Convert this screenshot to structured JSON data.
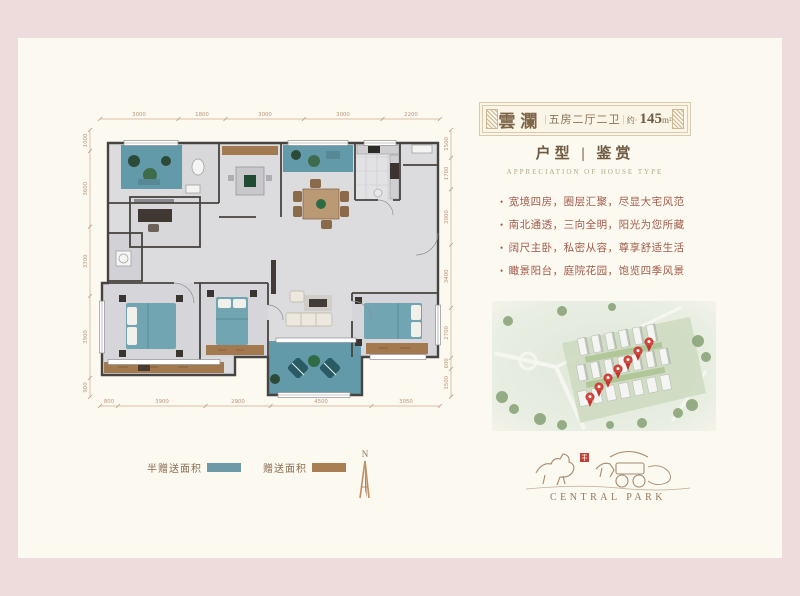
{
  "palette": {
    "page_bg": "#eddcdb",
    "panel_bg": "#fcf9f0",
    "teal": "#6e9aa7",
    "brown": "#a87e52",
    "text_brown": "#8a6e52",
    "bullet_red": "#a05a4a"
  },
  "title_card": {
    "name": "雲瀾",
    "divider": "|",
    "layout": "五房二厅二卫",
    "area_prefix": "约",
    "area_value": "145",
    "area_unit": "m²"
  },
  "section_header": {
    "cn": "户型 | 鉴赏",
    "en": "APPRECIATION OF HOUSE TYPE"
  },
  "selling_points": [
    "宽境四房，圈层汇聚，尽显大宅风范",
    "南北通透，三向全明，阳光为您所藏",
    "阔尺主卧，私密从容，尊享舒适生活",
    "瞰景阳台，庭院花园，饱览四季风景"
  ],
  "floorplan": {
    "dims_top": [
      "3000",
      "1800",
      "3000",
      "3000",
      "2200"
    ],
    "dims_bottom": [
      "800",
      "3900",
      "2900",
      "4500",
      "3050"
    ],
    "dims_left": [
      "1000",
      "3600",
      "3300",
      "3900",
      "900"
    ],
    "dims_right": [
      "1500",
      "1700",
      "3000",
      "3400",
      "2700",
      "600",
      "1500"
    ]
  },
  "legend": {
    "items": [
      {
        "label": "半赠送面积",
        "color": "#6e9aa7"
      },
      {
        "label": "赠送面积",
        "color": "#a87e52"
      }
    ]
  },
  "compass": {
    "label": "N"
  },
  "site_map": {
    "pin_count": 7
  },
  "logo": {
    "text": "CENTRAL PARK"
  }
}
